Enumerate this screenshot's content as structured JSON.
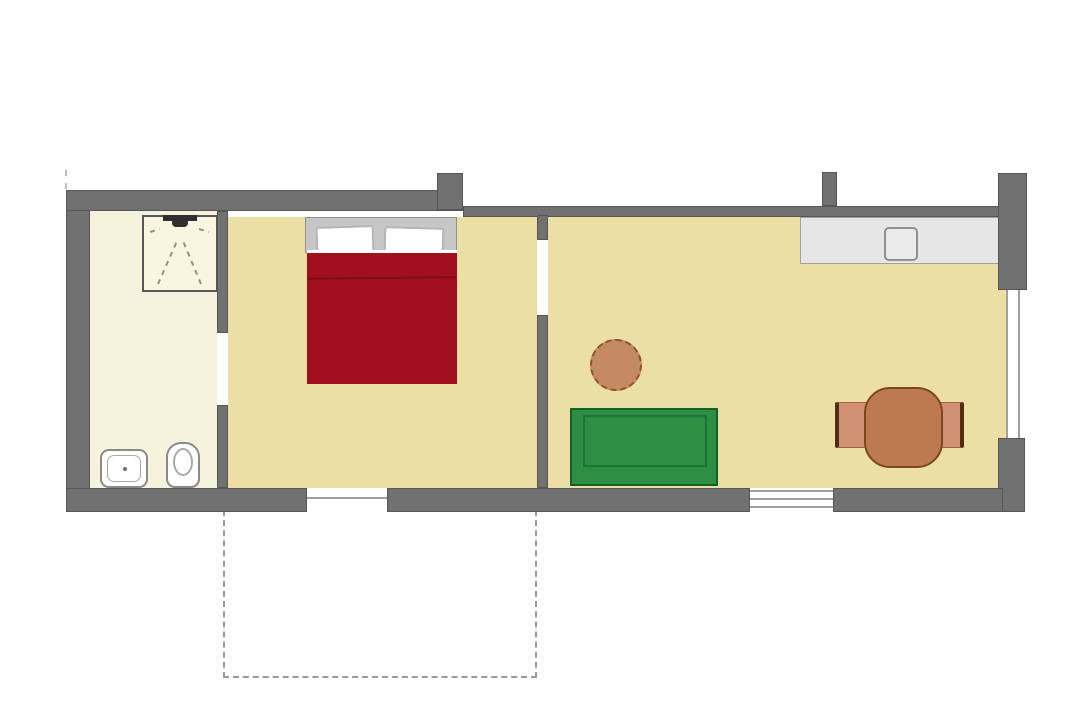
{
  "colors": {
    "background": "#ffffff",
    "wall": "#717171",
    "wall_outline": "#565656",
    "bathroom_floor": "#f5f2dd",
    "room_floor": "#ecdfa6",
    "shower_fill": "#f8f5e1",
    "shower_dash": "#9d9170",
    "shower_symbol": "#2f2f2f",
    "fixture_white": "#ffffff",
    "fixture_outline": "#8a8a8a",
    "counter_fill": "#e6e6e6",
    "counter_outline": "#a0a0a0",
    "window_line": "#a0a0a0",
    "terrace_dash": "#9a9a9a",
    "headboard": "#c7c7c7",
    "pillow_outline": "#b5b5b5",
    "blanket": "#a21020",
    "blanket_fold": "#7c0c18",
    "sofa": "#2e8f44",
    "sofa_outline": "#155f2a",
    "sofa_seat_line": "#1a7434",
    "pouf": "#c68a62",
    "pouf_outline": "#8a5434",
    "dining_table": "#bd7a50",
    "dining_table_outline": "#7c471e",
    "chair": "#d09175",
    "chair_outline": "#a5663d",
    "chair_back": "#4f2d10"
  },
  "plan": {
    "type": "apartment-floor-plan",
    "rooms": [
      {
        "id": "bathroom",
        "fixtures": [
          "shower",
          "washbasin",
          "toilet"
        ]
      },
      {
        "id": "bedroom",
        "furniture": [
          "double-bed-with-two-pillows"
        ]
      },
      {
        "id": "living-kitchen",
        "furniture": [
          "kitchen-counter-with-sink",
          "green-sofa",
          "round-side-table",
          "dining-table-with-two-chairs"
        ]
      }
    ],
    "outdoor": [
      {
        "id": "terrace",
        "rendering": "dashed-outline"
      }
    ],
    "openings": [
      "bathroom-door",
      "bedroom-door",
      "bedroom-terrace-window",
      "living-terrace-window",
      "living-side-window"
    ]
  }
}
